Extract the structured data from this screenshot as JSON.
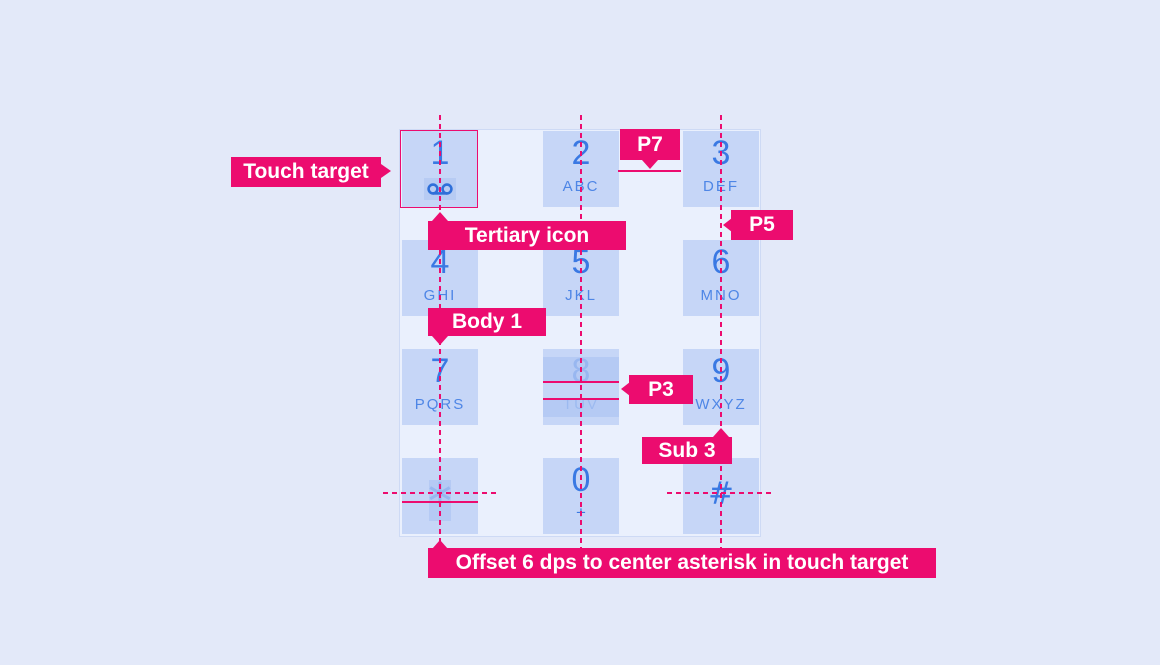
{
  "colors": {
    "accent": "#EC0C6F",
    "digit": "#3A79E3",
    "letters": "#4E86E6",
    "tile": "#C6D6F7",
    "page_bg": "#E3E9F9",
    "panel_bg": "#EAF0FD",
    "panel_border": "#CEDAF5",
    "highlight": "#B7CBF3"
  },
  "keypad": {
    "keys": [
      {
        "digit": "1",
        "letters": "",
        "icon": "voicemail-icon"
      },
      {
        "digit": "2",
        "letters": "ABC"
      },
      {
        "digit": "3",
        "letters": "DEF"
      },
      {
        "digit": "4",
        "letters": "GHI"
      },
      {
        "digit": "5",
        "letters": "JKL"
      },
      {
        "digit": "6",
        "letters": "MNO"
      },
      {
        "digit": "7",
        "letters": "PQRS"
      },
      {
        "digit": "8",
        "letters": "TUV"
      },
      {
        "digit": "9",
        "letters": "WXYZ"
      },
      {
        "digit": "∗",
        "letters": ""
      },
      {
        "digit": "0",
        "letters": "+"
      },
      {
        "digit": "#",
        "letters": ""
      }
    ]
  },
  "annotations": {
    "touch_target": "Touch target",
    "tertiary_icon": "Tertiary icon",
    "body_1": "Body 1",
    "p7": "P7",
    "p5": "P5",
    "p3": "P3",
    "sub_3": "Sub 3",
    "offset_note": "Offset 6 dps to center asterisk in touch target"
  }
}
